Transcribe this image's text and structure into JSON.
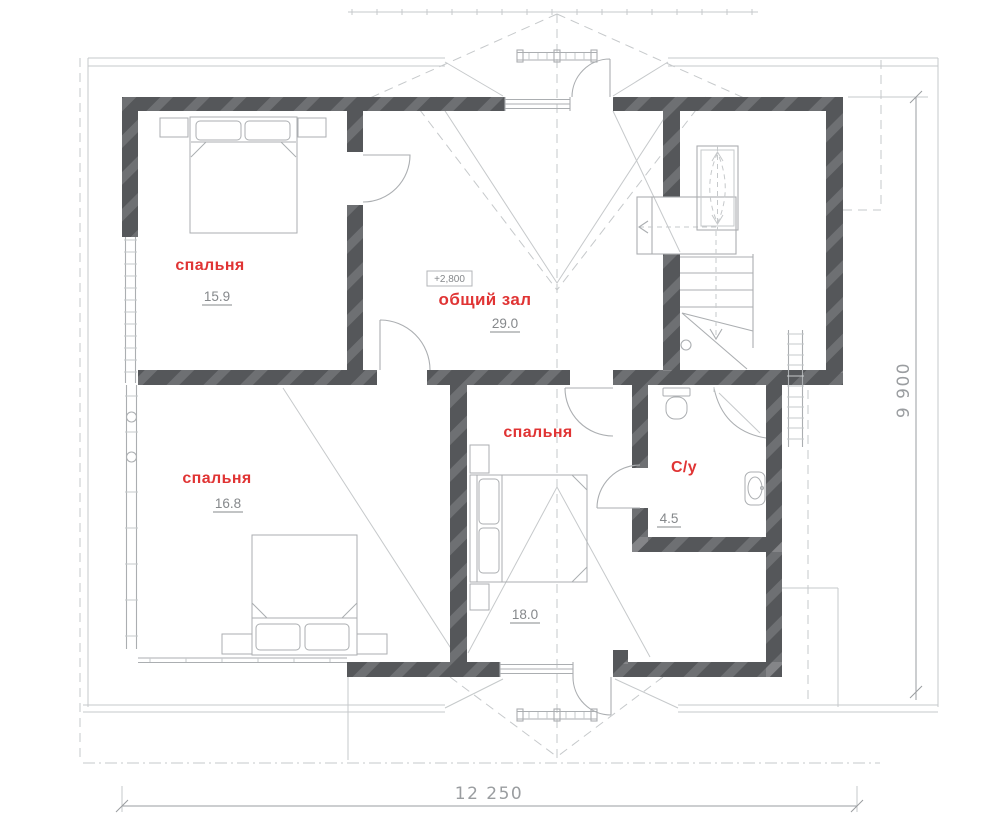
{
  "plan": {
    "type": "floor-plan",
    "rooms": [
      {
        "id": "bedroom-top-left",
        "name": "спальня",
        "area": "15.9"
      },
      {
        "id": "hall",
        "name": "общий зал",
        "area": "29.0"
      },
      {
        "id": "bedroom-bottom-left",
        "name": "спальня",
        "area": "16.8"
      },
      {
        "id": "bedroom-bottom-middle",
        "name": "спальня",
        "area": "18.0"
      },
      {
        "id": "bathroom",
        "name": "С/у",
        "area": "4.5"
      }
    ],
    "elevation_mark": "+2,800",
    "dimensions": {
      "width_bottom": "12 250",
      "height_right": "9 900"
    }
  },
  "colors": {
    "wall": "#55575a",
    "label": "#e03434",
    "lines": "#abaeb1",
    "light_lines": "#c6c9cb",
    "numbers": "#85888b",
    "dimensions": "#9a9da0",
    "background": "#ffffff"
  }
}
